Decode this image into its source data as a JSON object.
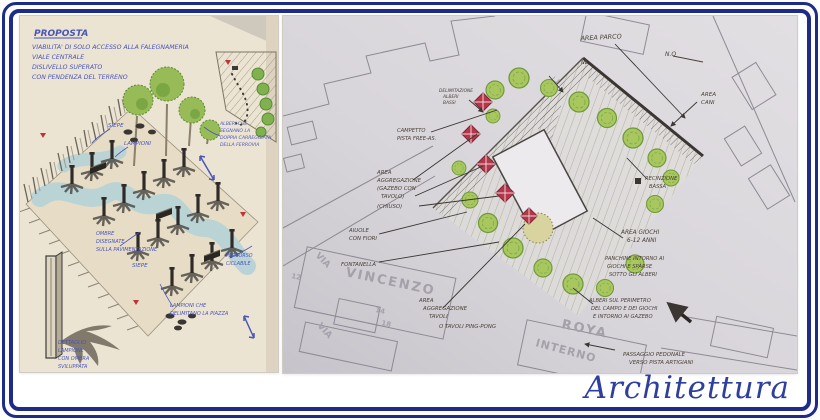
{
  "frame": {
    "border_color": "#1e2c87",
    "background": "#ffffff"
  },
  "brand": {
    "label": "Architettura",
    "color": "#2e3f9d"
  },
  "left_sketch": {
    "paper_color": "#ece4d3",
    "ink_color": "#4a55b8",
    "accent_red": "#c03338",
    "water_color": "#b7d2d6",
    "tree_color": "#97bb56",
    "title": "PROPOSTA",
    "notes": [
      "VIABILITA' DI SOLO ACCESSO ALLA FALEGNAMERIA",
      "VIALE CENTRALE",
      "DISLIVELLO SUPERATO",
      "CON PENDENZA DEL TERRENO"
    ],
    "labels": {
      "siepe_top": "SIEPE",
      "lampioni": "LAMPIONI",
      "alberi_1": "ALBERI CHE",
      "alberi_2": "SEGNANO LA",
      "alberi_3": "DOPPIA CARREGGIATA",
      "alberi_4": "DELLA FERROVIA",
      "ombre_1": "OMBRE",
      "ombre_2": "DISEGNATE",
      "ombre_3": "SULLA PAVIMENTAZIONE",
      "siepe_bottom": "SIEPE",
      "lampioni_piazza_1": "LAMPIONI CHE",
      "lampioni_piazza_2": "DELIMITANO LA PIAZZA",
      "percorso_1": "PERCORSO",
      "percorso_2": "CICLABILE",
      "dettaglio_1": "DETTAGLIO",
      "dettaglio_2": "LAMPIONE",
      "dettaglio_3": "CON OMBRA",
      "dettaglio_4": "SVILUPPATA"
    }
  },
  "right_plan": {
    "paper_color": "#d8d5da",
    "ink_color": "#4a4038",
    "tree_color": "#a9c75f",
    "gazebo_color": "#b5364a",
    "labels": {
      "area_parco": "AREA PARCO",
      "delimitazione_1": "DELIMITAZIONE",
      "delimitazione_2": "ALBERI",
      "delimitazione_3": "BASSI",
      "compass": "N.O",
      "corner_mark": "NE",
      "area_cani_1": "AREA",
      "area_cani_2": "CANI",
      "recinzione_1": "RECINZIONE",
      "recinzione_2": "BASSA",
      "area_giochi_1": "AREA GIOCHI",
      "area_giochi_2": "6-12 ANNI",
      "panchine_1": "PANCHINE INTORNO AI",
      "panchine_2": "GIOCHI E SPARSE",
      "panchine_3": "SOTTO GLI ALBERI",
      "alberi_perimetro_1": "ALBERI SUL PERIMETRO",
      "alberi_perimetro_2": "DEL CAMPO E DEI GIOCHI",
      "alberi_perimetro_3": "E INTORNO AI GAZEBO",
      "passaggio_1": "PASSAGGIO PEDONALE",
      "passaggio_2": "VERSO PISTA ARTIGIANI",
      "campetto_1": "CAMPETTO",
      "campetto_2": "PISTA FREE-AS.",
      "aggregazione_1": "AREA",
      "aggregazione_2": "AGGREGAZIONE",
      "aggregazione_3": "(GAZEBO CON",
      "aggregazione_4": "TAVOLO)",
      "aggregazione_5": "(CHIUSO)",
      "aiuole_1": "AIUOLE",
      "aiuole_2": "CON FIORI",
      "fontanella": "FONTANELLA",
      "tavoli_1": "AREA",
      "tavoli_2": "AGGREGAZIONE",
      "tavoli_3": "TAVOLI",
      "tavoli_4": "O TAVOLI PING-PONG"
    },
    "streets": {
      "via_upper": "VIA",
      "via_lower": "VIA",
      "vincenzo": "VINCENZO",
      "roya": "ROYA",
      "interno": "INTERNO"
    },
    "building_numbers": {
      "n12": "12",
      "n14": "14",
      "n18": "18"
    }
  }
}
